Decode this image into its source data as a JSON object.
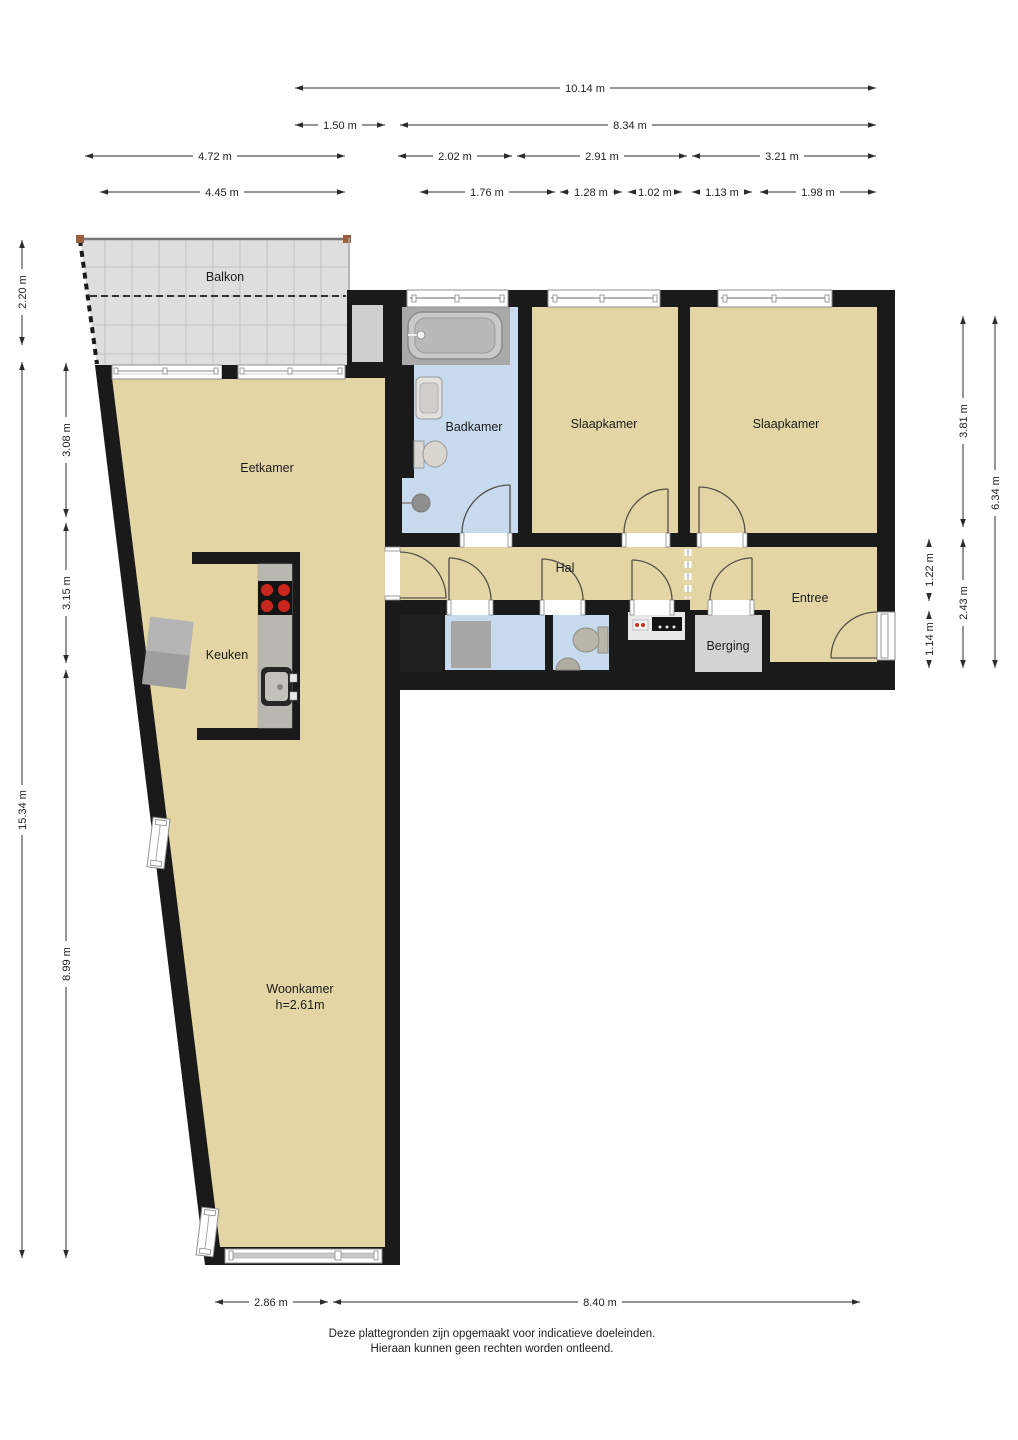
{
  "floorplan": {
    "rooms": {
      "balkon": "Balkon",
      "eetkamer": "Eetkamer",
      "badkamer": "Badkamer",
      "slaapkamer_links": "Slaapkamer",
      "slaapkamer_rechts": "Slaapkamer",
      "hal": "Hal",
      "entree": "Entree",
      "keuken": "Keuken",
      "berging": "Berging",
      "woonkamer": "Woonkamer",
      "woonkamer_hoogte": "h=2.61m"
    },
    "dimensions_top": [
      "10.14 m",
      "1.50 m",
      "8.34 m",
      "4.72 m",
      "2.02 m",
      "2.91 m",
      "3.21 m",
      "4.45 m",
      "1.76 m",
      "1.28 m",
      "1.02 m",
      "1.13 m",
      "1.98 m"
    ],
    "dimensions_left": [
      "2.20 m",
      "3.08 m",
      "3.15 m",
      "15.34 m",
      "8.99 m"
    ],
    "dimensions_right": [
      "3.81 m",
      "6.34 m",
      "1.22 m",
      "2.43 m",
      "1.14 m"
    ],
    "dimensions_bottom": [
      "2.86 m",
      "8.40 m"
    ],
    "disclaimer": [
      "Deze plattegronden zijn opgemaakt voor indicatieve doeleinden.",
      "Hieraan kunnen geen rechten worden ontleend."
    ],
    "colors": {
      "wall": "#1a1a1a",
      "floor": "#e3d5a4",
      "wet_room": "#c7daee",
      "balcony": "#dedede",
      "storage_room": "#d3d3d1",
      "counter": "#b8b7b2",
      "burner_red": "#c9271d",
      "dimension_line": "#2b2b2b"
    }
  }
}
